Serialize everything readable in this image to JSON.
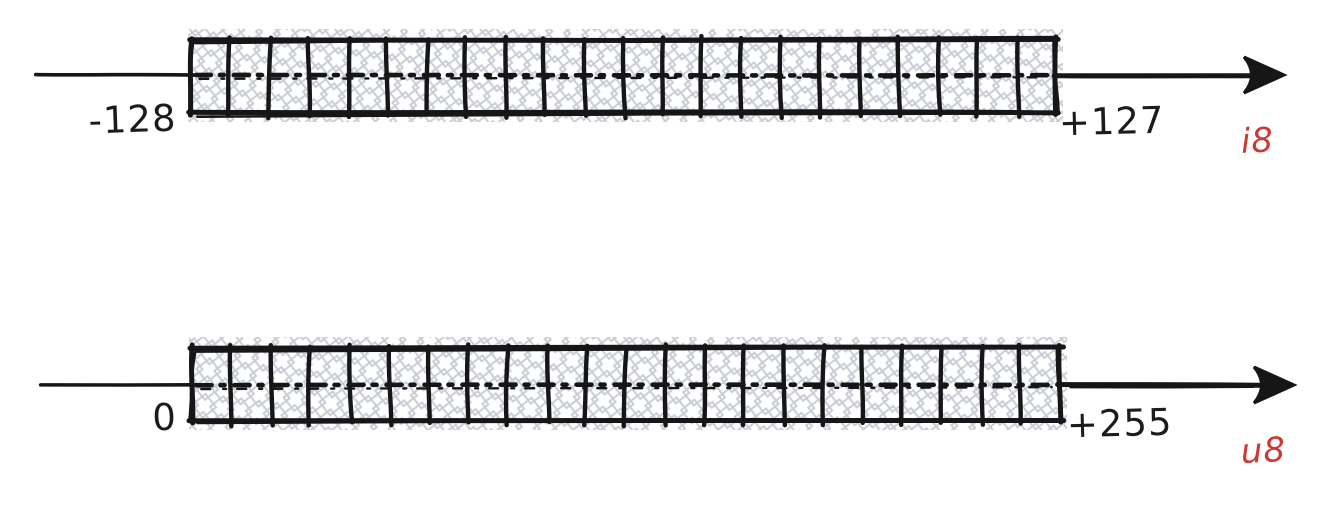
{
  "canvas": {
    "width": 1332,
    "height": 506,
    "background": "#ffffff"
  },
  "style": {
    "ink_color": "#161616",
    "hatch_color": "#c9cdd5",
    "number_label_color": "#1b1b1b",
    "type_label_color": "#cc3a36"
  },
  "number_lines": [
    {
      "id": "i8",
      "type_label": "i8",
      "min_label": "-128",
      "max_label": "+127",
      "min_value": -128,
      "max_value": 127,
      "cells": 22,
      "layout": {
        "mid_y": 75,
        "tail_x": 36,
        "box_left": 191,
        "box_right": 1056,
        "box_top": 40,
        "box_bottom": 112,
        "arrow_tip_x": 1284,
        "min_label_x": 133,
        "min_label_y": 132,
        "max_label_x": 1112,
        "max_label_y": 134,
        "type_label_x": 1258,
        "type_label_y": 152
      }
    },
    {
      "id": "u8",
      "type_label": "u8",
      "min_label": "0",
      "max_label": "+255",
      "min_value": 0,
      "max_value": 255,
      "cells": 22,
      "layout": {
        "mid_y": 385,
        "tail_x": 40,
        "box_left": 192,
        "box_right": 1060,
        "box_top": 348,
        "box_bottom": 420,
        "arrow_tip_x": 1294,
        "min_label_x": 165,
        "min_label_y": 430,
        "max_label_x": 1120,
        "max_label_y": 436,
        "type_label_x": 1264,
        "type_label_y": 462
      }
    }
  ]
}
